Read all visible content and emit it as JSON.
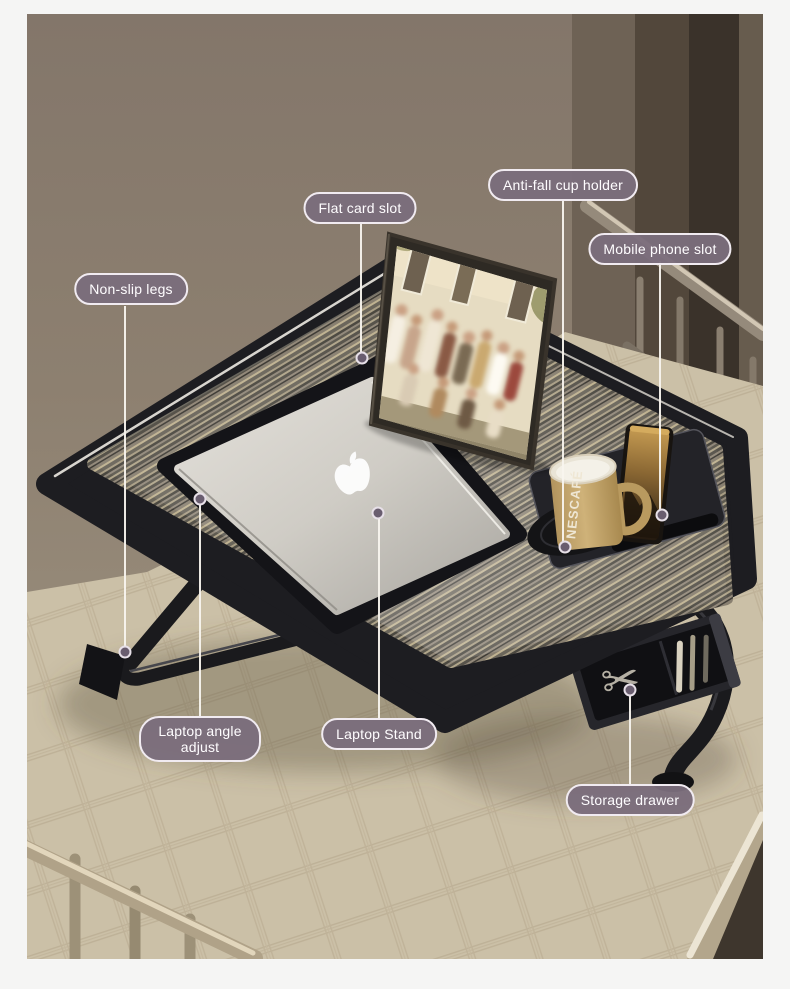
{
  "scene": {
    "description": "Foldable laptop bed desk on a mattress with laptop, tablet, mug, phone and open storage drawer",
    "mug_brand_text": "NESCAFÉ"
  },
  "callouts": {
    "flat_card_slot": {
      "label": "Flat card slot"
    },
    "anti_fall_cup_holder": {
      "label": "Anti-fall cup holder"
    },
    "mobile_phone_slot": {
      "label": "Mobile phone slot"
    },
    "non_slip_legs": {
      "label": "Non-slip legs"
    },
    "laptop_angle_adjust": {
      "label": "Laptop angle adjust"
    },
    "laptop_stand": {
      "label": "Laptop Stand"
    },
    "storage_drawer": {
      "label": "Storage drawer"
    }
  },
  "colors": {
    "callout_bg": "#7b6d7c",
    "callout_border": "#f1ebf1",
    "callout_text": "#ffffff",
    "callout_line": "#f6f2ea",
    "table_frame": "#1d1d21",
    "wall": "#8b7e6d",
    "mattress": "#cbc0a7",
    "page_margin": "#f5f5f4"
  }
}
